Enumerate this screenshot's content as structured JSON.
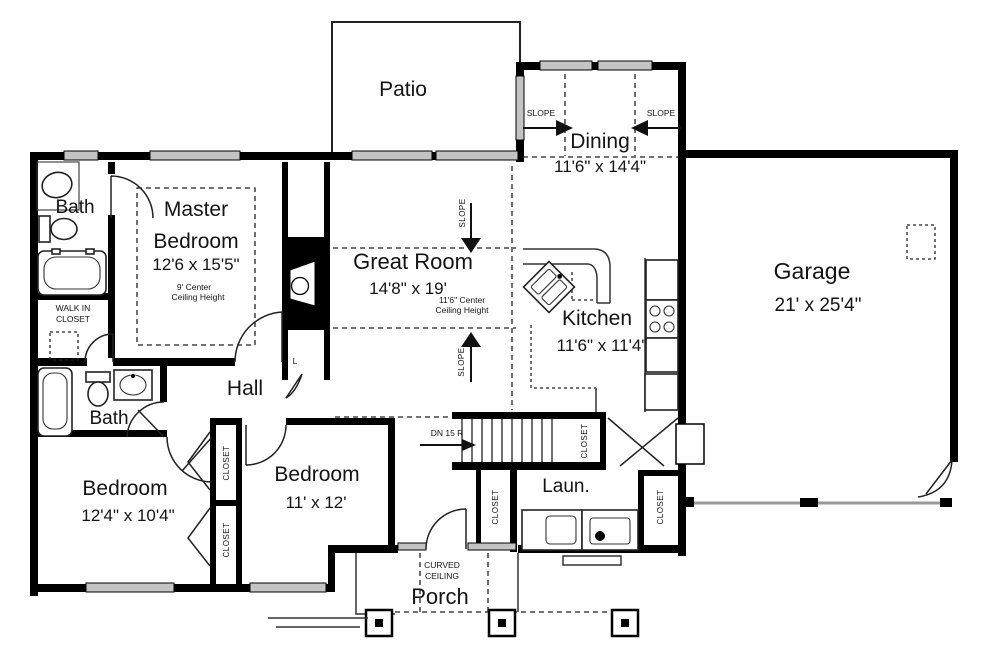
{
  "plan": {
    "rooms": {
      "patio": {
        "name": "Patio"
      },
      "dining": {
        "name": "Dining",
        "dims": "11'6\" x 14'4\""
      },
      "garage": {
        "name": "Garage",
        "dims": "21' x 25'4\""
      },
      "master_bedroom": {
        "name_line1": "Master",
        "name_line2": "Bedroom",
        "dims": "12'6 x 15'5\"",
        "ceiling_line1": "9' Center",
        "ceiling_line2": "Ceiling Height"
      },
      "great_room": {
        "name": "Great Room",
        "dims": "14'8\" x 19'",
        "ceiling_line1": "11'6\" Center",
        "ceiling_line2": "Ceiling Height"
      },
      "kitchen": {
        "name": "Kitchen",
        "dims": "11'6\" x 11'4\""
      },
      "master_bath": {
        "name": "Bath"
      },
      "walk_in_closet": {
        "line1": "WALK IN",
        "line2": "CLOSET"
      },
      "hall": {
        "name": "Hall"
      },
      "bath2": {
        "name": "Bath"
      },
      "bedroom1": {
        "name": "Bedroom",
        "dims": "12'4\" x 10'4\""
      },
      "bedroom2": {
        "name": "Bedroom",
        "dims": "11' x 12'"
      },
      "laundry": {
        "name": "Laun."
      },
      "porch": {
        "name": "Porch",
        "ceiling_line1": "CURVED",
        "ceiling_line2": "CEILING"
      }
    },
    "annotations": {
      "slope": "SLOPE",
      "stair_direction": "DN 15 R",
      "linen_closet": "L",
      "closet": "CLOSET"
    }
  }
}
